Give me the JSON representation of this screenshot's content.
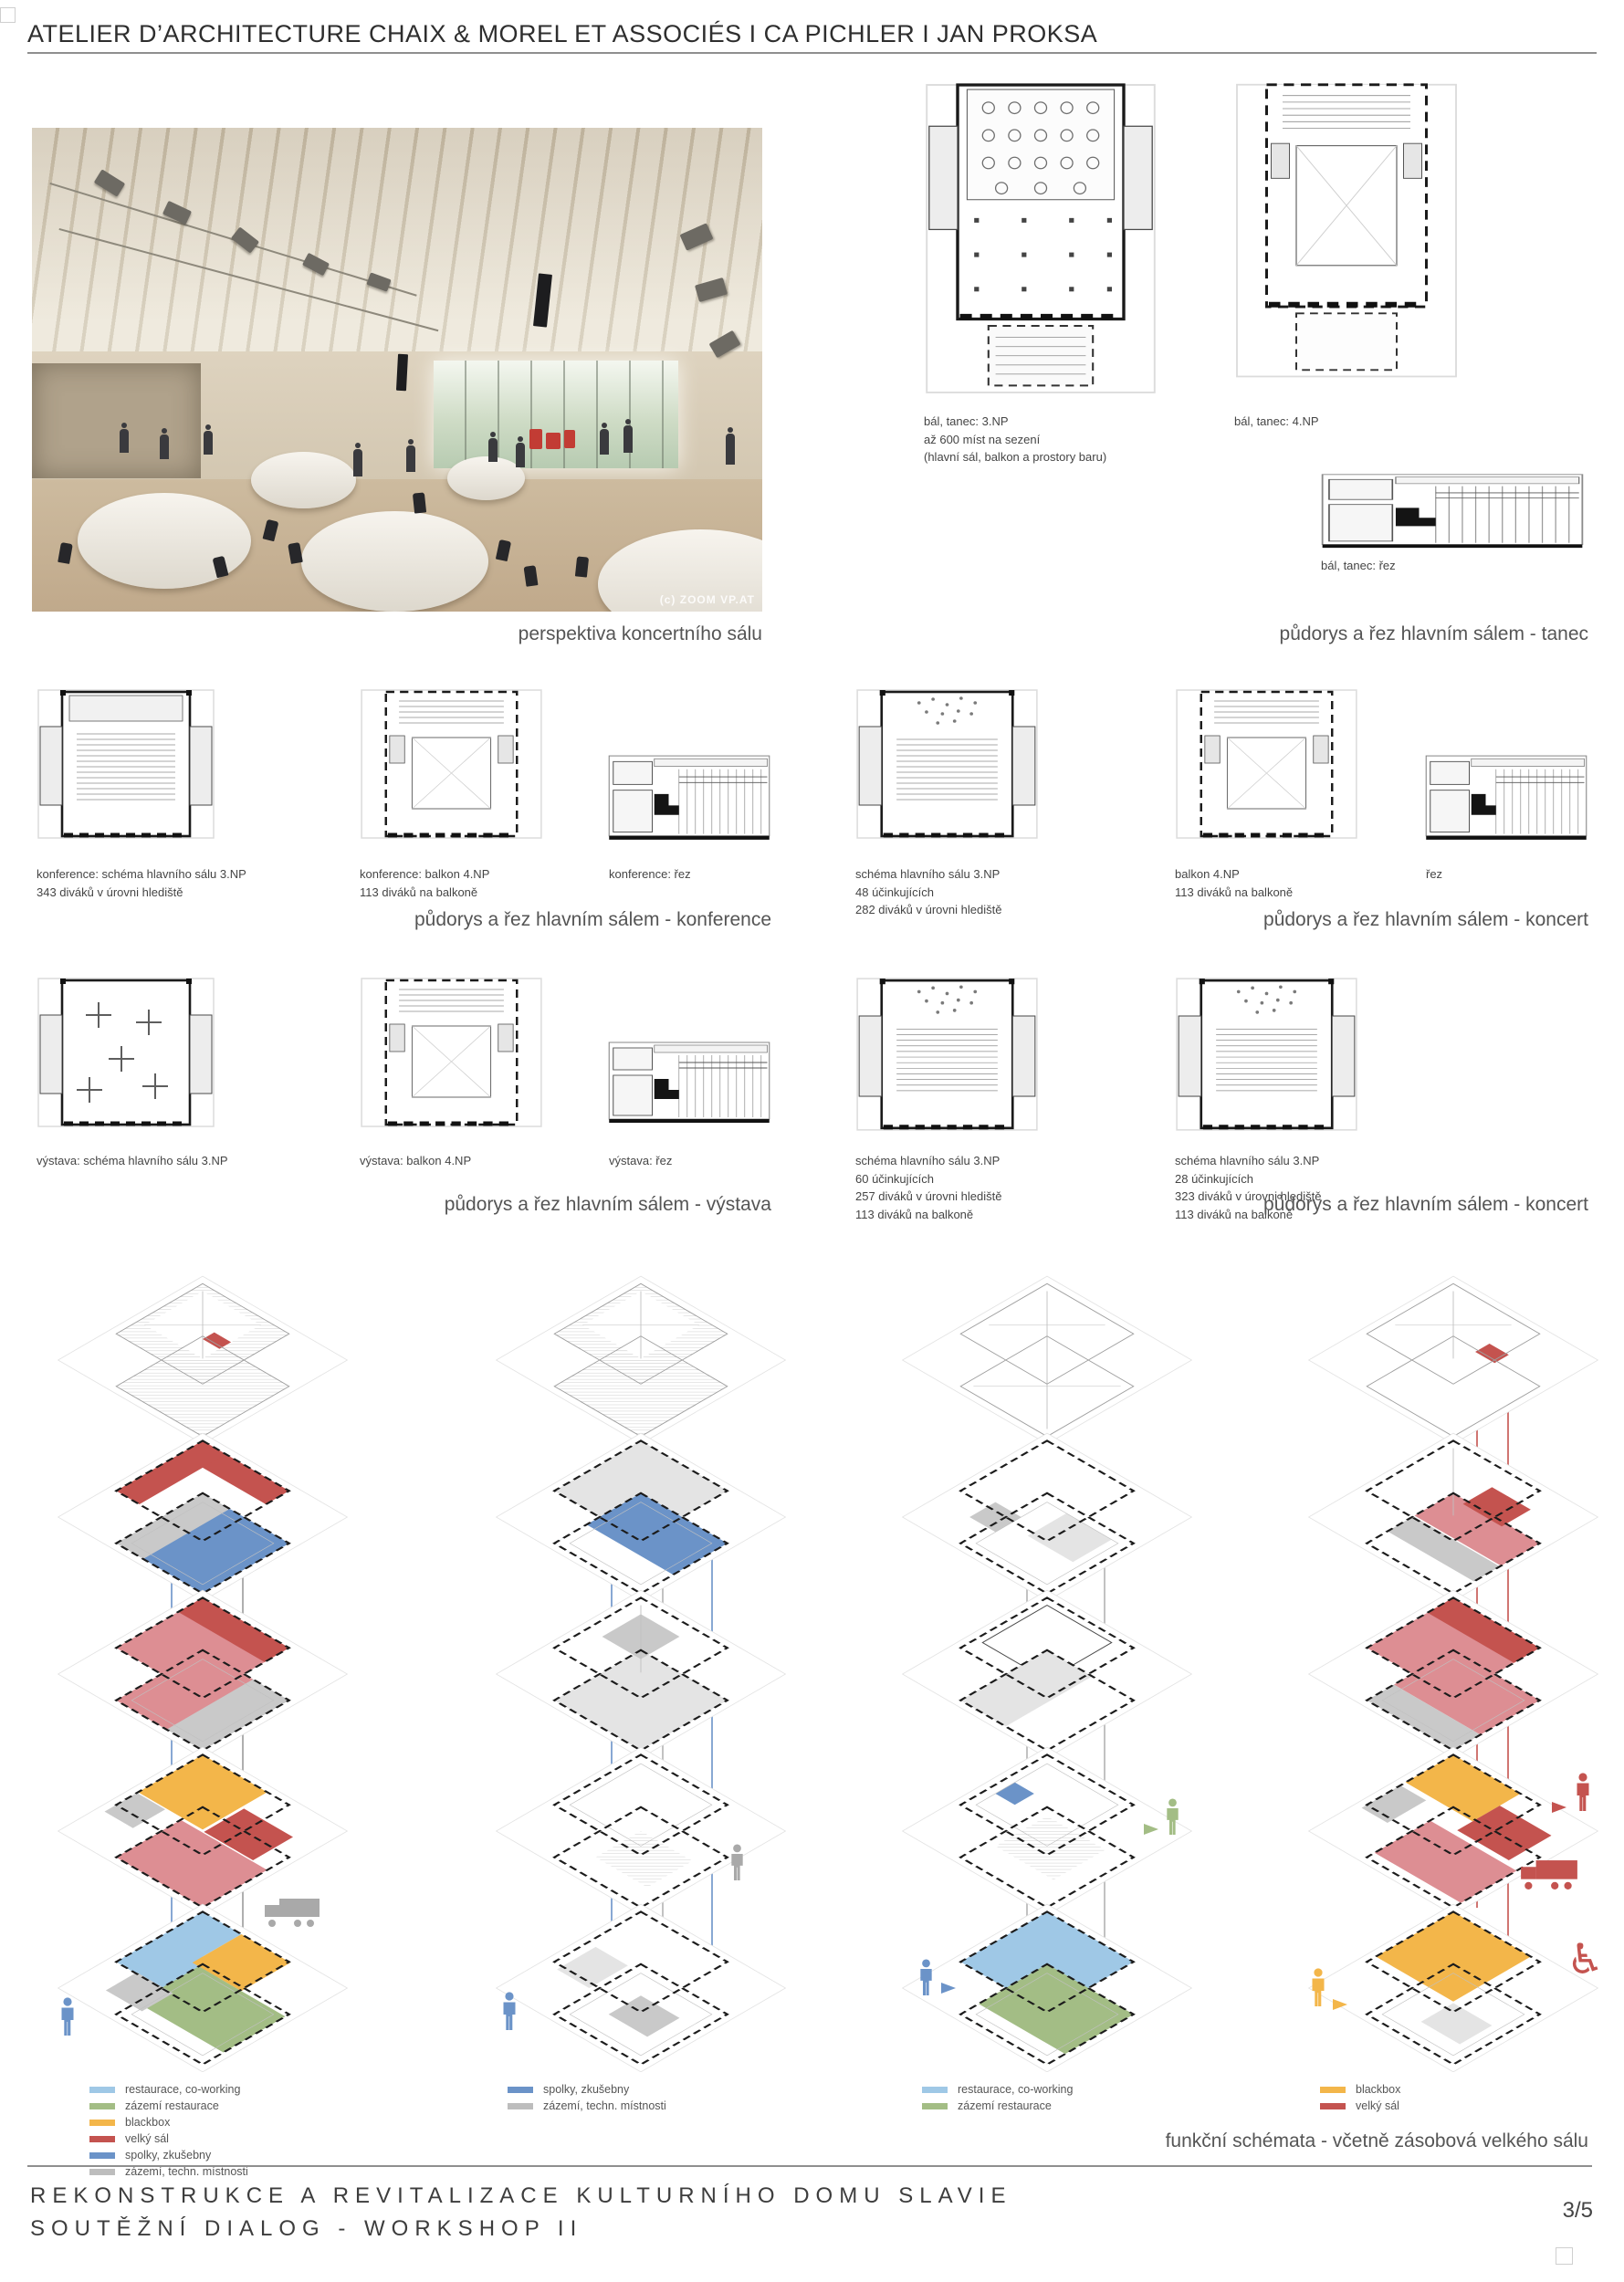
{
  "palette": {
    "restaurace": "#9fc8e6",
    "zazemi_rest": "#a3bd85",
    "blackbox": "#f3b64a",
    "velky_sal": "#c4534f",
    "velky_sal_light": "#dd8e93",
    "spolky": "#6b93c8",
    "zazemi_tech": "#bdbdbd"
  },
  "header": {
    "title": "ATELIER D’ARCHITECTURE CHAIX & MOREL ET ASSOCIÉS  I  CA PICHLER  I  JAN PROKSA"
  },
  "photo": {
    "caption": "perspektiva koncertního sálu",
    "watermark": "(c) ZOOM VP.AT"
  },
  "tanec": {
    "caption": "půdorys a řez hlavním sálem - tanec",
    "plan1": {
      "l1": "bál, tanec: 3.NP",
      "l2": "až 600 míst na sezení",
      "l3": "(hlavní sál, balkon a prostory baru)"
    },
    "plan2": {
      "l1": "bál, tanec: 4.NP"
    },
    "rez": {
      "l1": "bál, tanec: řez"
    }
  },
  "konference": {
    "caption": "půdorys a řez hlavním sálem - konference",
    "plan1": {
      "l1": "konference: schéma hlavního sálu 3.NP",
      "l2": "343 diváků v úrovni hlediště"
    },
    "plan2": {
      "l1": "konference: balkon 4.NP",
      "l2": "113 diváků na balkoně"
    },
    "rez": {
      "l1": "konference: řez"
    }
  },
  "koncert1": {
    "caption": "půdorys a řez hlavním sálem - koncert",
    "plan1": {
      "l1": "schéma hlavního sálu 3.NP",
      "l2": "48 účinkujících",
      "l3": "282 diváků v úrovni hlediště"
    },
    "plan2": {
      "l1": "balkon 4.NP",
      "l2": "113 diváků na balkoně"
    },
    "rez": {
      "l1": "řez"
    }
  },
  "vystava": {
    "caption": "půdorys a řez hlavním sálem - výstava",
    "plan1": {
      "l1": "výstava: schéma hlavního sálu 3.NP"
    },
    "plan2": {
      "l1": "výstava: balkon 4.NP"
    },
    "rez": {
      "l1": "výstava: řez"
    }
  },
  "koncert2": {
    "caption": "půdorys a řez hlavním sálem - koncert",
    "plan1": {
      "l1": "schéma hlavního sálu 3.NP",
      "l2": "60 účinkujících",
      "l3": "257 diváků v úrovni hlediště",
      "l4": "113 diváků na balkoně"
    },
    "plan2": {
      "l1": "schéma hlavního sálu 3.NP",
      "l2": "28 účinkujících",
      "l3": "323 diváků v úrovni hlediště",
      "l4": "113 diváků na balkoně"
    }
  },
  "funkcni": {
    "caption": "funkční schémata - včetně zásobová velkého sálu"
  },
  "legends": {
    "a": {
      "items": [
        {
          "key": "restaurace",
          "label": "restaurace, co-working"
        },
        {
          "key": "zazemi_rest",
          "label": "zázemí restaurace"
        },
        {
          "key": "blackbox",
          "label": "blackbox"
        },
        {
          "key": "velky_sal",
          "label": "velký sál"
        },
        {
          "key": "spolky",
          "label": "spolky, zkušebny"
        },
        {
          "key": "zazemi_tech",
          "label": "zázemí, techn. místnosti"
        }
      ]
    },
    "b": {
      "items": [
        {
          "key": "spolky",
          "label": "spolky, zkušebny"
        },
        {
          "key": "zazemi_tech",
          "label": "zázemí, techn. místnosti"
        }
      ]
    },
    "c": {
      "items": [
        {
          "key": "restaurace",
          "label": "restaurace, co-working"
        },
        {
          "key": "zazemi_rest",
          "label": "zázemí restaurace"
        }
      ]
    },
    "d": {
      "items": [
        {
          "key": "blackbox",
          "label": "blackbox"
        },
        {
          "key": "velky_sal",
          "label": "velký sál"
        }
      ]
    }
  },
  "footer": {
    "line1": "REKONSTRUKCE A REVITALIZACE KULTURNÍHO DOMU SLAVIE",
    "line2": "SOUTĚŽNÍ DIALOG - WORKSHOP II",
    "page": "3/5"
  }
}
